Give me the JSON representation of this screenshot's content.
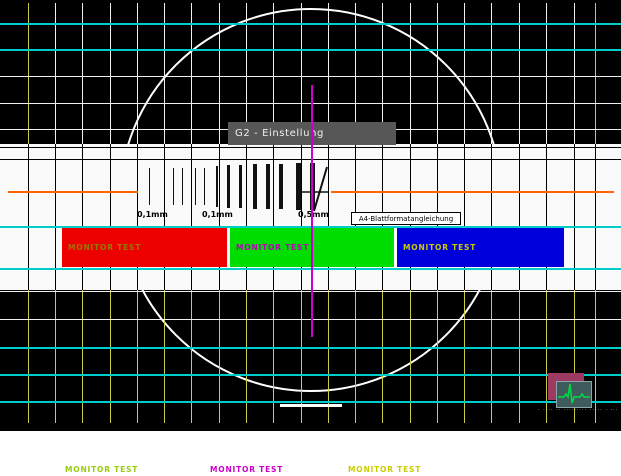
{
  "card": {
    "width": 621,
    "height": 476
  },
  "palette": {
    "black": "#000000",
    "band_white": "#FAFAFA",
    "grid_white": "#F0F0F0",
    "grid_cyan": "#00CCCC",
    "grid_yellow": "#CCCC44",
    "grid_black": "#000000",
    "circle_white": "#FFFFFF",
    "orange": "#FF6600",
    "magenta": "#CC00CC",
    "gray_box_bg": "#575757",
    "gray_box_text": "#F0F0F0",
    "red_bar": "#EE0000",
    "green_bar": "#00DD00",
    "blue_bar": "#0000DD",
    "red_bar_text": "#997700",
    "green_bar_text": "#BB00BB",
    "blue_bar_text": "#CCCC00",
    "footer_green": "#99CC11",
    "footer_magenta": "#CC00CC",
    "footer_yellow": "#CCCC00",
    "pattern_black": "#111111",
    "marker_white": "#FFFFFF",
    "logo_outer": "#9C3A62",
    "logo_inner": "#3F5B5C",
    "logo_trace": "#00DD44",
    "logo_caption": "#DDDDDD"
  },
  "grid": {
    "columns": [
      28,
      55,
      82,
      110,
      137,
      164,
      191,
      219,
      246,
      273,
      301,
      328,
      355,
      382,
      410,
      437,
      464,
      491,
      519,
      546,
      574,
      595
    ],
    "yellow_columns": [
      28,
      595
    ],
    "top_rows": [
      {
        "y": 23,
        "color": "cyan",
        "h": 2
      },
      {
        "y": 49,
        "color": "cyan",
        "h": 2
      },
      {
        "y": 76,
        "color": "white",
        "h": 1
      },
      {
        "y": 103,
        "color": "white",
        "h": 1
      },
      {
        "y": 129,
        "color": "white",
        "h": 1
      }
    ],
    "mid_rows": [
      {
        "y": 147,
        "h": 1
      },
      {
        "y": 159,
        "h": 1
      }
    ],
    "bottom_rows": [
      {
        "y": 291,
        "color": "white",
        "h": 1
      },
      {
        "y": 319,
        "color": "white",
        "h": 1
      },
      {
        "y": 347,
        "color": "cyan",
        "h": 2
      },
      {
        "y": 374,
        "color": "cyan",
        "h": 2
      },
      {
        "y": 401,
        "color": "cyan",
        "h": 2
      }
    ]
  },
  "g2_box": {
    "label": "G2 - Einstellung"
  },
  "resolution_pattern": {
    "lines": [
      {
        "x": 149,
        "w": 1,
        "y": 168,
        "h": 37
      },
      {
        "x": 173,
        "w": 1,
        "y": 168,
        "h": 37
      },
      {
        "x": 182,
        "w": 1,
        "y": 168,
        "h": 37
      },
      {
        "x": 195,
        "w": 1,
        "y": 168,
        "h": 37
      },
      {
        "x": 204,
        "w": 1,
        "y": 168,
        "h": 37
      },
      {
        "x": 216,
        "w": 2,
        "y": 166,
        "h": 41
      },
      {
        "x": 227,
        "w": 3,
        "y": 165,
        "h": 43
      },
      {
        "x": 239,
        "w": 3,
        "y": 165,
        "h": 43
      },
      {
        "x": 253,
        "w": 4,
        "y": 164,
        "h": 45
      },
      {
        "x": 266,
        "w": 4,
        "y": 164,
        "h": 45
      },
      {
        "x": 279,
        "w": 4,
        "y": 164,
        "h": 45
      },
      {
        "x": 296,
        "w": 5,
        "y": 163,
        "h": 47
      },
      {
        "x": 310,
        "w": 5,
        "y": 163,
        "h": 47
      }
    ],
    "labels": [
      {
        "text": "0,1mm",
        "x": 137
      },
      {
        "text": "0,1mm",
        "x": 202
      },
      {
        "text": "0,5mm",
        "x": 298
      }
    ],
    "format_box": {
      "label": "A4-Blattformatangleichung"
    }
  },
  "bars": [
    {
      "id": "red",
      "label": "MONITOR TEST",
      "x": 62,
      "width": 165,
      "fill": "red_bar",
      "text_color": "red_bar_text"
    },
    {
      "id": "green",
      "label": "MONITOR TEST",
      "x": 230,
      "width": 164,
      "fill": "green_bar",
      "text_color": "green_bar_text"
    },
    {
      "id": "blue",
      "label": "MONITOR TEST",
      "x": 397,
      "width": 167,
      "fill": "blue_bar",
      "text_color": "blue_bar_text"
    }
  ],
  "footer": {
    "labels": [
      {
        "text": "MONITOR TEST",
        "x": 65,
        "color": "footer_green"
      },
      {
        "text": "MONITOR TEST",
        "x": 210,
        "color": "footer_magenta"
      },
      {
        "text": "MONITOR TEST",
        "x": 348,
        "color": "footer_yellow"
      }
    ]
  },
  "logo": {
    "caption": "· ···· ·· ········· ····· · ···· ····"
  }
}
